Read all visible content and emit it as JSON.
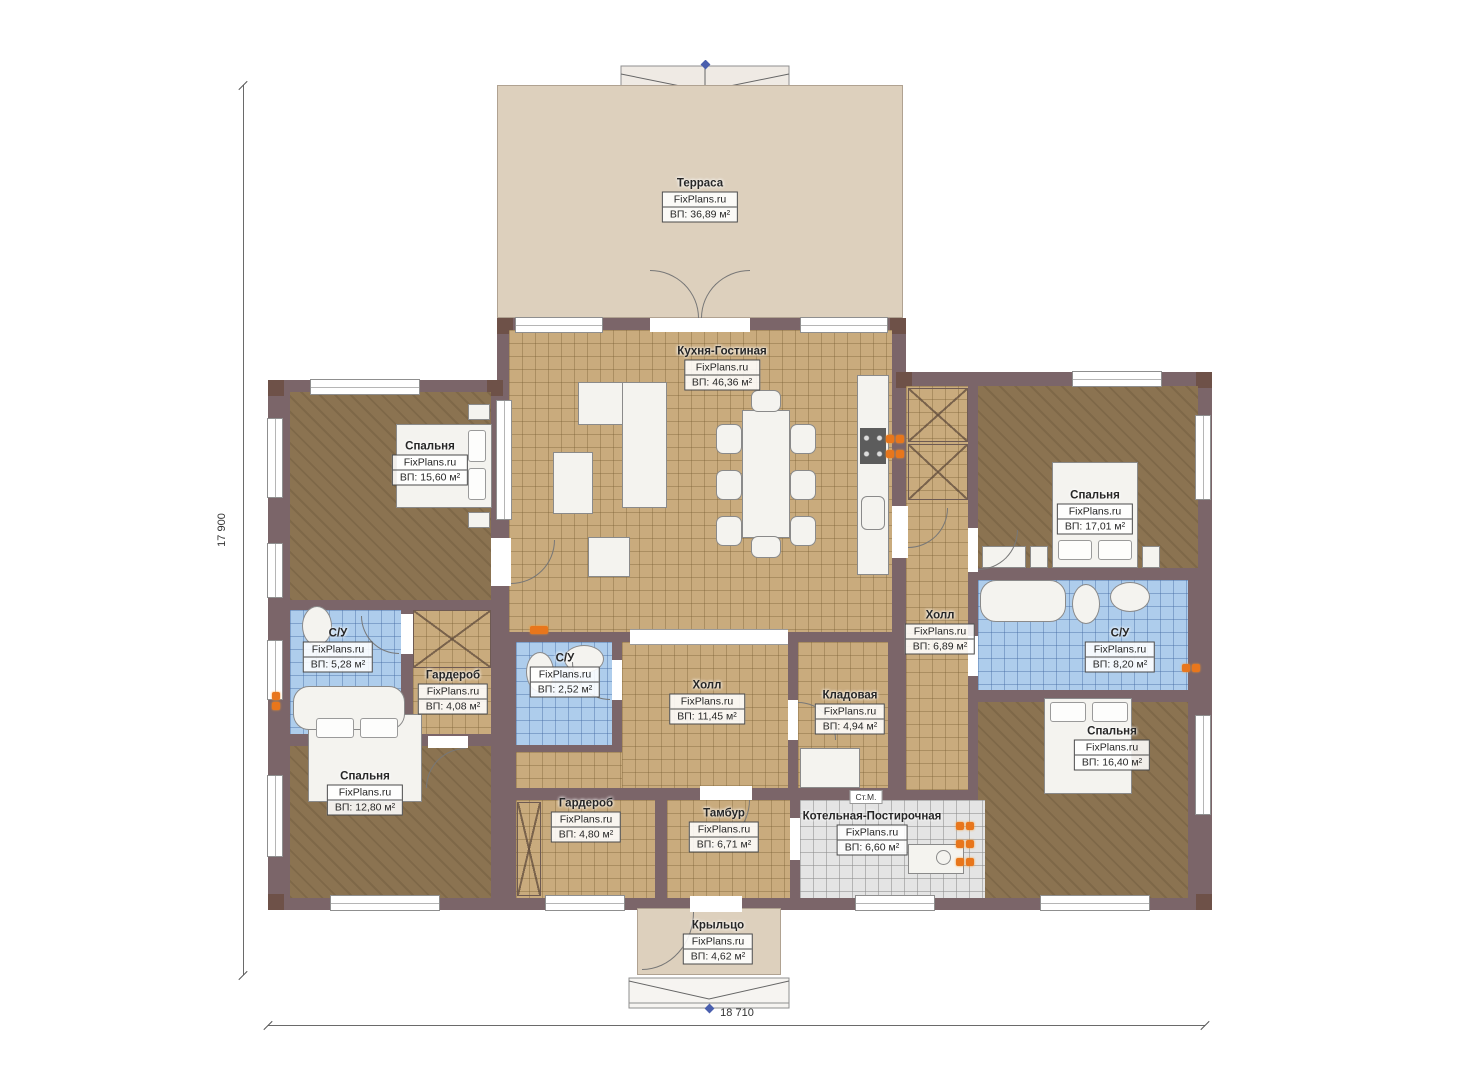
{
  "plan_title": "Одноэтажный дом — план этажа",
  "brand": "FixPlans.ru",
  "dimensions": {
    "height_label": "17 900",
    "width_label": "18 710"
  },
  "labels": {
    "washing_machine": "Ст.М."
  },
  "colors": {
    "wall": "#7b6569",
    "column": "#6e5148",
    "floor_wood": "#8b7351",
    "floor_tile": "#c9ab7d",
    "floor_bath": "#aecdec",
    "floor_boiler": "#e4e4e4",
    "terrace": "#ddd0bd",
    "radiator": "#e8761c"
  },
  "rooms": [
    {
      "id": "terrace",
      "name": "Терраса",
      "brand": "FixPlans.ru",
      "area": "ВП: 36,89 м²"
    },
    {
      "id": "kitchen-living",
      "name": "Кухня-Гостиная",
      "brand": "FixPlans.ru",
      "area": "ВП: 46,36 м²"
    },
    {
      "id": "bedroom-1",
      "name": "Спальня",
      "brand": "FixPlans.ru",
      "area": "ВП: 15,60 м²"
    },
    {
      "id": "bedroom-2",
      "name": "Спальня",
      "brand": "FixPlans.ru",
      "area": "ВП: 17,01 м²"
    },
    {
      "id": "bathroom-1",
      "name": "С/У",
      "brand": "FixPlans.ru",
      "area": "ВП: 5,28 м²"
    },
    {
      "id": "wardrobe-1",
      "name": "Гардероб",
      "brand": "FixPlans.ru",
      "area": "ВП: 4,08 м²"
    },
    {
      "id": "bathroom-2",
      "name": "С/У",
      "brand": "FixPlans.ru",
      "area": "ВП: 2,52 м²"
    },
    {
      "id": "hall-1",
      "name": "Холл",
      "brand": "FixPlans.ru",
      "area": "ВП: 11,45 м²"
    },
    {
      "id": "pantry",
      "name": "Кладовая",
      "brand": "FixPlans.ru",
      "area": "ВП: 4,94 м²"
    },
    {
      "id": "hall-2",
      "name": "Холл",
      "brand": "FixPlans.ru",
      "area": "ВП: 6,89 м²"
    },
    {
      "id": "bathroom-3",
      "name": "С/У",
      "brand": "FixPlans.ru",
      "area": "ВП: 8,20 м²"
    },
    {
      "id": "bedroom-3",
      "name": "Спальня",
      "brand": "FixPlans.ru",
      "area": "ВП: 16,40 м²"
    },
    {
      "id": "bedroom-4",
      "name": "Спальня",
      "brand": "FixPlans.ru",
      "area": "ВП: 12,80 м²"
    },
    {
      "id": "wardrobe-2",
      "name": "Гардероб",
      "brand": "FixPlans.ru",
      "area": "ВП: 4,80 м²"
    },
    {
      "id": "vestibule",
      "name": "Тамбур",
      "brand": "FixPlans.ru",
      "area": "ВП: 6,71 м²"
    },
    {
      "id": "boiler-laundry",
      "name": "Котельная-Постирочная",
      "brand": "FixPlans.ru",
      "area": "ВП: 6,60 м²"
    },
    {
      "id": "porch",
      "name": "Крыльцо",
      "brand": "FixPlans.ru",
      "area": "ВП: 4,62 м²"
    }
  ]
}
